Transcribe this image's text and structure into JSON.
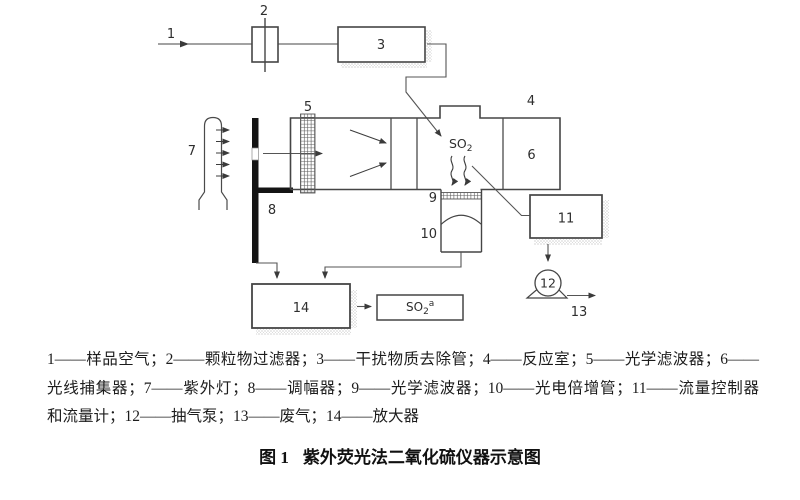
{
  "diagram": {
    "labels": {
      "1": "1",
      "2": "2",
      "3": "3",
      "4": "4",
      "5": "5",
      "6": "6",
      "7": "7",
      "8": "8",
      "9": "9",
      "10": "10",
      "11": "11",
      "12": "12",
      "13": "13",
      "14": "14"
    },
    "so2_chamber": {
      "base": "SO",
      "sub": "2"
    },
    "so2_output": {
      "base": "SO",
      "sub": "2",
      "sup": "a"
    },
    "colors": {
      "ink": "#3f3f3f",
      "bar_fill": "#141414",
      "stipple": "#9a9a9a"
    }
  },
  "legend": {
    "line1": "1——样品空气；2——颗粒物过滤器；3——干扰物质去除管；4——反应室；5——光学滤波器；6——",
    "line2": "光线捕集器；7——紫外灯；8——调幅器；9——光学滤波器；10——光电倍增管；11——流量控制器",
    "line3": "和流量计；12——抽气泵；13——废气；14——放大器"
  },
  "caption": {
    "figure_label": "图 1",
    "title": "紫外荧光法二氧化硫仪器示意图"
  }
}
